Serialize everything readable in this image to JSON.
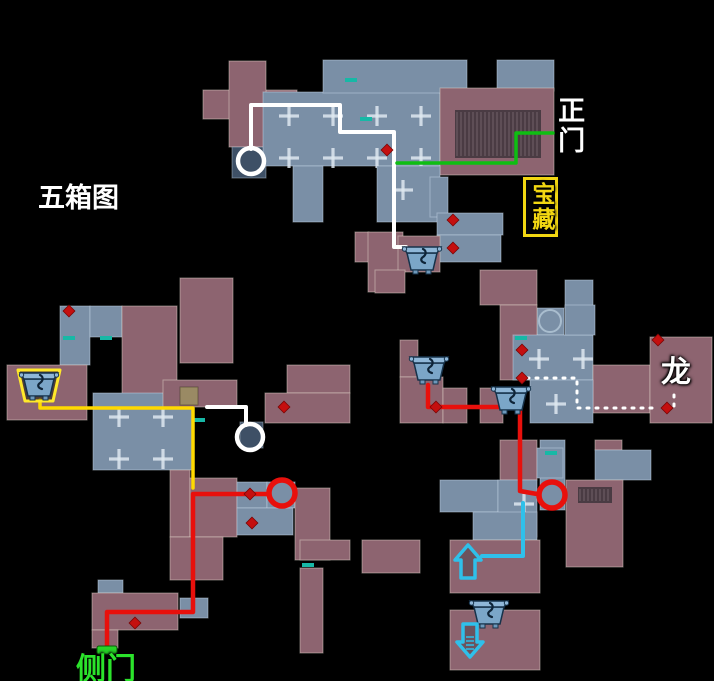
{
  "background": "#000000",
  "palette": {
    "roof": "#8d6470",
    "room": "#7a8fa6",
    "room_dark": "#3e5066",
    "stairs": "#4a3b43",
    "tan": "#9a8a64",
    "route_white": "#ffffff",
    "route_green": "#0ebe12",
    "route_yellow": "#ffd900",
    "route_red": "#e8100c",
    "route_cyan": "#2fc0ea",
    "poi_dot": "#c40f0f",
    "door_teal": "#17b8a6",
    "door_green": "#27d427",
    "chest_glow": "#ffe92a",
    "cross_mark": "rgba(222,231,240,0.85)"
  },
  "labels": [
    {
      "id": "map-title",
      "text": "五箱图",
      "x": 38,
      "y": 184,
      "color": "#ffffff",
      "size": 27,
      "vertical": false,
      "boxed": false
    },
    {
      "id": "main-gate",
      "text": "正门",
      "x": 554,
      "y": 96,
      "color": "#ffffff",
      "size": 27,
      "vertical": true,
      "boxed": false
    },
    {
      "id": "treasure",
      "text": "宝藏",
      "x": 523,
      "y": 177,
      "color": "#f2d712",
      "size": 23,
      "vertical": true,
      "boxed": true
    },
    {
      "id": "dragon",
      "text": "龙",
      "x": 661,
      "y": 357,
      "color": "#ffffff",
      "size": 30,
      "vertical": false,
      "boxed": false
    },
    {
      "id": "side-gate",
      "text": "侧门",
      "x": 76,
      "y": 654,
      "color": "#2be32b",
      "size": 30,
      "vertical": false,
      "boxed": false
    }
  ],
  "map": {
    "width": 714,
    "height": 681,
    "blocks": [
      [
        203,
        90,
        94,
        29,
        "roof"
      ],
      [
        229,
        61,
        37,
        86,
        "roof"
      ],
      [
        232,
        147,
        34,
        31,
        "dark"
      ],
      [
        263,
        92,
        177,
        74,
        "roomg"
      ],
      [
        323,
        60,
        144,
        33,
        "room"
      ],
      [
        497,
        60,
        57,
        31,
        "room"
      ],
      [
        440,
        88,
        114,
        87,
        "roof"
      ],
      [
        455,
        110,
        86,
        48,
        "stairs"
      ],
      [
        293,
        166,
        30,
        56,
        "room"
      ],
      [
        377,
        166,
        63,
        56,
        "roomg"
      ],
      [
        430,
        177,
        18,
        40,
        "room"
      ],
      [
        437,
        213,
        66,
        22,
        "room"
      ],
      [
        437,
        235,
        64,
        27,
        "room"
      ],
      [
        355,
        232,
        14,
        30,
        "roof"
      ],
      [
        368,
        232,
        35,
        60,
        "roof"
      ],
      [
        398,
        236,
        42,
        36,
        "roof"
      ],
      [
        375,
        270,
        30,
        23,
        "roof"
      ],
      [
        60,
        306,
        30,
        59,
        "room"
      ],
      [
        90,
        306,
        32,
        31,
        "room"
      ],
      [
        122,
        306,
        55,
        89,
        "roof"
      ],
      [
        180,
        278,
        53,
        85,
        "roof"
      ],
      [
        7,
        365,
        80,
        55,
        "roof"
      ],
      [
        93,
        393,
        100,
        77,
        "roomg"
      ],
      [
        163,
        380,
        74,
        27,
        "roof"
      ],
      [
        180,
        387,
        18,
        18,
        "tan"
      ],
      [
        287,
        365,
        63,
        28,
        "roof"
      ],
      [
        265,
        393,
        85,
        30,
        "roof"
      ],
      [
        240,
        422,
        23,
        26,
        "dark"
      ],
      [
        170,
        470,
        20,
        67,
        "roof"
      ],
      [
        190,
        478,
        47,
        59,
        "roof"
      ],
      [
        237,
        482,
        30,
        26,
        "room"
      ],
      [
        267,
        482,
        28,
        26,
        "room"
      ],
      [
        237,
        508,
        56,
        27,
        "room"
      ],
      [
        295,
        488,
        35,
        72,
        "roof"
      ],
      [
        300,
        540,
        50,
        20,
        "roof"
      ],
      [
        300,
        568,
        23,
        85,
        "roof"
      ],
      [
        362,
        540,
        58,
        33,
        "roof"
      ],
      [
        170,
        537,
        53,
        43,
        "roof"
      ],
      [
        98,
        580,
        25,
        13,
        "room"
      ],
      [
        92,
        593,
        86,
        37,
        "roof"
      ],
      [
        180,
        598,
        28,
        20,
        "room"
      ],
      [
        92,
        630,
        26,
        18,
        "roof"
      ],
      [
        480,
        270,
        57,
        35,
        "roof"
      ],
      [
        565,
        280,
        28,
        28,
        "room"
      ],
      [
        537,
        308,
        27,
        27,
        "room"
      ],
      [
        500,
        305,
        37,
        75,
        "roof"
      ],
      [
        513,
        335,
        80,
        45,
        "roomg"
      ],
      [
        565,
        305,
        30,
        30,
        "room"
      ],
      [
        400,
        340,
        18,
        37,
        "roof"
      ],
      [
        400,
        377,
        43,
        46,
        "roof"
      ],
      [
        443,
        388,
        24,
        35,
        "roof"
      ],
      [
        480,
        388,
        23,
        35,
        "roof"
      ],
      [
        593,
        365,
        57,
        48,
        "roof"
      ],
      [
        650,
        337,
        62,
        86,
        "roof"
      ],
      [
        530,
        380,
        63,
        43,
        "roomg"
      ],
      [
        540,
        440,
        25,
        70,
        "room"
      ],
      [
        595,
        440,
        27,
        10,
        "roof"
      ],
      [
        595,
        450,
        56,
        30,
        "room"
      ],
      [
        566,
        480,
        57,
        87,
        "roof"
      ],
      [
        578,
        487,
        34,
        16,
        "stairs"
      ],
      [
        500,
        440,
        37,
        40,
        "roof"
      ],
      [
        537,
        448,
        26,
        30,
        "room"
      ],
      [
        440,
        480,
        58,
        32,
        "room"
      ],
      [
        498,
        480,
        39,
        57,
        "roomg"
      ],
      [
        473,
        512,
        64,
        28,
        "room"
      ],
      [
        450,
        540,
        90,
        53,
        "roof"
      ],
      [
        450,
        610,
        90,
        60,
        "roof"
      ]
    ],
    "routes": [
      {
        "name": "white-route-main-hall",
        "color": "#ffffff",
        "width": 4,
        "dash": null,
        "points": [
          [
            251,
            149
          ],
          [
            251,
            105
          ],
          [
            340,
            105
          ],
          [
            340,
            132
          ],
          [
            394,
            132
          ],
          [
            394,
            247
          ],
          [
            406,
            247
          ]
        ]
      },
      {
        "name": "white-route-courtyard",
        "color": "#ffffff",
        "width": 4,
        "dash": null,
        "points": [
          [
            207,
            407
          ],
          [
            246,
            407
          ],
          [
            246,
            425
          ]
        ]
      },
      {
        "name": "green-route-main-gate",
        "color": "#0ebe12",
        "width": 3.5,
        "dash": null,
        "points": [
          [
            397,
            163
          ],
          [
            516,
            163
          ],
          [
            516,
            133
          ],
          [
            553,
            133
          ]
        ]
      },
      {
        "name": "yellow-route-left-chest",
        "color": "#ffd900",
        "width": 3.5,
        "dash": null,
        "points": [
          [
            40,
            400
          ],
          [
            40,
            408
          ],
          [
            193,
            408
          ],
          [
            193,
            488
          ]
        ]
      },
      {
        "name": "red-route-right",
        "color": "#e8100c",
        "width": 4.5,
        "dash": null,
        "points": [
          [
            428,
            385
          ],
          [
            428,
            407
          ],
          [
            520,
            407
          ],
          [
            520,
            491
          ],
          [
            537,
            494
          ]
        ]
      },
      {
        "name": "red-route-side-gate",
        "color": "#e8100c",
        "width": 4.5,
        "dash": null,
        "points": [
          [
            269,
            494
          ],
          [
            193,
            494
          ],
          [
            193,
            612
          ],
          [
            107,
            612
          ],
          [
            107,
            646
          ]
        ]
      },
      {
        "name": "cyan-route",
        "color": "#2fc0ea",
        "width": 4,
        "dash": null,
        "points": [
          [
            523,
            503
          ],
          [
            523,
            556
          ],
          [
            482,
            556
          ]
        ]
      },
      {
        "name": "dragon-dotted-route",
        "color": "#ffffff",
        "width": 3,
        "dash": "2 7",
        "points": [
          [
            527,
            378
          ],
          [
            577,
            378
          ],
          [
            577,
            408
          ],
          [
            659,
            408
          ]
        ]
      },
      {
        "name": "dragon-dotted-branch",
        "color": "#ffffff",
        "width": 3,
        "dash": "2 7",
        "points": [
          [
            674,
            406
          ],
          [
            674,
            391
          ]
        ]
      }
    ],
    "circles": [
      {
        "name": "white-route-circle-1",
        "x": 251,
        "y": 161,
        "r": 13,
        "color": "#ffffff",
        "width": 4.5
      },
      {
        "name": "white-route-circle-2",
        "x": 250,
        "y": 437,
        "r": 13,
        "color": "#ffffff",
        "width": 4.5
      },
      {
        "name": "red-route-circle-left",
        "x": 282,
        "y": 493,
        "r": 13,
        "color": "#e8100c",
        "width": 5.5
      },
      {
        "name": "red-route-circle-right",
        "x": 552,
        "y": 495,
        "r": 13,
        "color": "#e8100c",
        "width": 5.5
      },
      {
        "name": "pavilion-circle",
        "x": 550,
        "y": 321,
        "r": 11,
        "color": "rgba(190,208,224,0.7)",
        "width": 2
      }
    ],
    "chests": [
      {
        "name": "treasure-chest-icon",
        "x": 422,
        "y": 260,
        "glow": false
      },
      {
        "name": "treasure-chest-icon-highlighted",
        "x": 39,
        "y": 386,
        "glow": true
      },
      {
        "name": "treasure-chest-icon",
        "x": 429,
        "y": 370,
        "glow": false
      },
      {
        "name": "treasure-chest-icon",
        "x": 511,
        "y": 400,
        "glow": false
      },
      {
        "name": "treasure-chest-icon",
        "x": 489,
        "y": 614,
        "glow": false
      }
    ],
    "dots": [
      [
        387,
        150
      ],
      [
        453,
        220
      ],
      [
        453,
        248
      ],
      [
        69,
        311
      ],
      [
        284,
        407
      ],
      [
        436,
        407
      ],
      [
        250,
        494
      ],
      [
        252,
        523
      ],
      [
        135,
        623
      ],
      [
        522,
        350
      ],
      [
        522,
        378
      ],
      [
        667,
        408
      ],
      [
        658,
        340
      ]
    ],
    "teal_doors": [
      [
        345,
        78
      ],
      [
        360,
        117
      ],
      [
        63,
        336
      ],
      [
        100,
        336
      ],
      [
        193,
        418
      ],
      [
        302,
        563
      ],
      [
        515,
        336
      ],
      [
        545,
        451
      ]
    ],
    "green_door": {
      "x": 97,
      "y": 646,
      "w": 20,
      "h": 8
    },
    "arrows": [
      {
        "name": "jump-up-arrow-icon",
        "x": 468,
        "y": 562,
        "dir": "up"
      },
      {
        "name": "jump-down-arrow-icon",
        "x": 470,
        "y": 640,
        "dir": "down"
      }
    ]
  }
}
